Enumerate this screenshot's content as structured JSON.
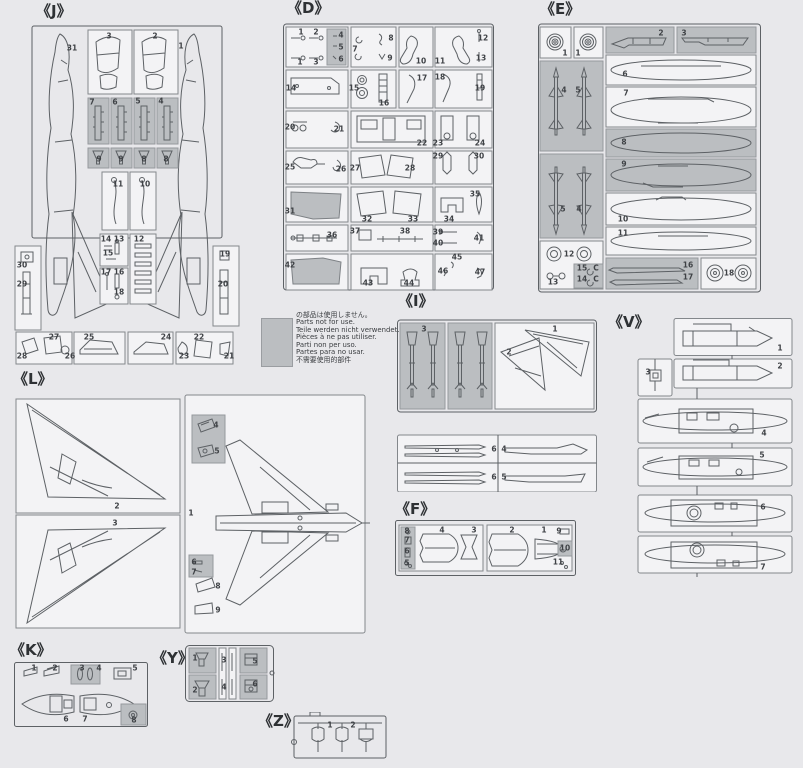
{
  "colors": {
    "background": "#e8e8eb",
    "box_fill": "#f3f3f5",
    "shaded_fill": "#bbbec1",
    "line": "#5d6165",
    "frame": "#83878b",
    "text": "#3f4246"
  },
  "note": {
    "lines": [
      "の部品は使用しません。",
      "Parts not for use.",
      "Teile werden nicht verwendet.",
      "Pièces à ne pas utiliser.",
      "Parti non per uso.",
      "Partes para no usar.",
      "不需要使用的部件"
    ]
  },
  "sprues": {
    "J": {
      "label": "《J》",
      "parts": [
        {
          "t": "31",
          "x": 58,
          "y": 26
        },
        {
          "t": "3",
          "x": 95,
          "y": 14
        },
        {
          "t": "2",
          "x": 141,
          "y": 14
        },
        {
          "t": "1",
          "x": 167,
          "y": 24
        },
        {
          "t": "7",
          "x": 78,
          "y": 80
        },
        {
          "t": "6",
          "x": 101,
          "y": 80
        },
        {
          "t": "5",
          "x": 124,
          "y": 79
        },
        {
          "t": "4",
          "x": 147,
          "y": 79
        },
        {
          "t": "9",
          "x": 85,
          "y": 137
        },
        {
          "t": "9",
          "x": 107,
          "y": 137
        },
        {
          "t": "8",
          "x": 130,
          "y": 137
        },
        {
          "t": "8",
          "x": 152,
          "y": 137
        },
        {
          "t": "11",
          "x": 104,
          "y": 162
        },
        {
          "t": "10",
          "x": 131,
          "y": 162
        },
        {
          "t": "14",
          "x": 92,
          "y": 217
        },
        {
          "t": "13",
          "x": 105,
          "y": 217
        },
        {
          "t": "15",
          "x": 94,
          "y": 231
        },
        {
          "t": "12",
          "x": 125,
          "y": 217
        },
        {
          "t": "17",
          "x": 92,
          "y": 250
        },
        {
          "t": "16",
          "x": 105,
          "y": 250
        },
        {
          "t": "18",
          "x": 105,
          "y": 270
        },
        {
          "t": "30",
          "x": 8,
          "y": 243
        },
        {
          "t": "29",
          "x": 8,
          "y": 262
        },
        {
          "t": "19",
          "x": 211,
          "y": 232
        },
        {
          "t": "20",
          "x": 209,
          "y": 262
        },
        {
          "t": "28",
          "x": 8,
          "y": 334
        },
        {
          "t": "27",
          "x": 40,
          "y": 315
        },
        {
          "t": "26",
          "x": 56,
          "y": 334
        },
        {
          "t": "25",
          "x": 75,
          "y": 315
        },
        {
          "t": "24",
          "x": 152,
          "y": 315
        },
        {
          "t": "23",
          "x": 170,
          "y": 334
        },
        {
          "t": "22",
          "x": 185,
          "y": 315
        },
        {
          "t": "21",
          "x": 215,
          "y": 334
        }
      ]
    },
    "D": {
      "label": "《D》",
      "parts": [
        {
          "t": "1",
          "x": 18,
          "y": 10
        },
        {
          "t": "2",
          "x": 33,
          "y": 10
        },
        {
          "t": "1",
          "x": 17,
          "y": 40
        },
        {
          "t": "3",
          "x": 33,
          "y": 40
        },
        {
          "t": "4",
          "x": 58,
          "y": 13
        },
        {
          "t": "5",
          "x": 58,
          "y": 25
        },
        {
          "t": "6",
          "x": 58,
          "y": 37
        },
        {
          "t": "7",
          "x": 72,
          "y": 27
        },
        {
          "t": "8",
          "x": 108,
          "y": 16
        },
        {
          "t": "9",
          "x": 107,
          "y": 36
        },
        {
          "t": "10",
          "x": 138,
          "y": 39
        },
        {
          "t": "11",
          "x": 157,
          "y": 39
        },
        {
          "t": "12",
          "x": 200,
          "y": 16
        },
        {
          "t": "13",
          "x": 198,
          "y": 36
        },
        {
          "t": "14",
          "x": 8,
          "y": 66
        },
        {
          "t": "15",
          "x": 71,
          "y": 66
        },
        {
          "t": "16",
          "x": 101,
          "y": 81
        },
        {
          "t": "17",
          "x": 139,
          "y": 56
        },
        {
          "t": "18",
          "x": 157,
          "y": 55
        },
        {
          "t": "19",
          "x": 197,
          "y": 66
        },
        {
          "t": "20",
          "x": 7,
          "y": 105
        },
        {
          "t": "21",
          "x": 56,
          "y": 107
        },
        {
          "t": "22",
          "x": 139,
          "y": 121
        },
        {
          "t": "23",
          "x": 155,
          "y": 121
        },
        {
          "t": "24",
          "x": 197,
          "y": 121
        },
        {
          "t": "25",
          "x": 7,
          "y": 145
        },
        {
          "t": "26",
          "x": 58,
          "y": 147
        },
        {
          "t": "27",
          "x": 72,
          "y": 146
        },
        {
          "t": "28",
          "x": 127,
          "y": 146
        },
        {
          "t": "29",
          "x": 155,
          "y": 134
        },
        {
          "t": "30",
          "x": 196,
          "y": 134
        },
        {
          "t": "31",
          "x": 7,
          "y": 189
        },
        {
          "t": "32",
          "x": 84,
          "y": 197
        },
        {
          "t": "33",
          "x": 130,
          "y": 197
        },
        {
          "t": "34",
          "x": 166,
          "y": 197
        },
        {
          "t": "35",
          "x": 192,
          "y": 172
        },
        {
          "t": "36",
          "x": 49,
          "y": 213
        },
        {
          "t": "37",
          "x": 72,
          "y": 209
        },
        {
          "t": "38",
          "x": 122,
          "y": 209
        },
        {
          "t": "39",
          "x": 155,
          "y": 210
        },
        {
          "t": "40",
          "x": 155,
          "y": 221
        },
        {
          "t": "41",
          "x": 196,
          "y": 216
        },
        {
          "t": "42",
          "x": 7,
          "y": 243
        },
        {
          "t": "43",
          "x": 85,
          "y": 261
        },
        {
          "t": "44",
          "x": 126,
          "y": 261
        },
        {
          "t": "45",
          "x": 174,
          "y": 235
        },
        {
          "t": "46",
          "x": 160,
          "y": 249
        },
        {
          "t": "47",
          "x": 197,
          "y": 250
        }
      ]
    },
    "E": {
      "label": "《E》",
      "parts": [
        {
          "t": "1",
          "x": 27,
          "y": 31
        },
        {
          "t": "1",
          "x": 40,
          "y": 31
        },
        {
          "t": "2",
          "x": 123,
          "y": 11
        },
        {
          "t": "3",
          "x": 146,
          "y": 11
        },
        {
          "t": "4",
          "x": 26,
          "y": 68
        },
        {
          "t": "5",
          "x": 40,
          "y": 68
        },
        {
          "t": "6",
          "x": 87,
          "y": 52
        },
        {
          "t": "7",
          "x": 88,
          "y": 71
        },
        {
          "t": "8",
          "x": 86,
          "y": 120
        },
        {
          "t": "5",
          "x": 25,
          "y": 187
        },
        {
          "t": "4",
          "x": 41,
          "y": 187
        },
        {
          "t": "9",
          "x": 86,
          "y": 142
        },
        {
          "t": "10",
          "x": 85,
          "y": 197
        },
        {
          "t": "11",
          "x": 85,
          "y": 211
        },
        {
          "t": "12",
          "x": 31,
          "y": 232
        },
        {
          "t": "13",
          "x": 15,
          "y": 260
        },
        {
          "t": "15",
          "x": 44,
          "y": 246
        },
        {
          "t": "C",
          "x": 58,
          "y": 246
        },
        {
          "t": "14",
          "x": 44,
          "y": 257
        },
        {
          "t": "C",
          "x": 58,
          "y": 257
        },
        {
          "t": "16",
          "x": 150,
          "y": 243
        },
        {
          "t": "17",
          "x": 150,
          "y": 255
        },
        {
          "t": "18",
          "x": 191,
          "y": 251
        }
      ]
    },
    "I": {
      "label": "《I》",
      "parts": [
        {
          "t": "3",
          "x": 27,
          "y": 13
        },
        {
          "t": "1",
          "x": 158,
          "y": 13
        },
        {
          "t": "2",
          "x": 112,
          "y": 36
        },
        {
          "t": "6",
          "x": 97,
          "y": 133
        },
        {
          "t": "4",
          "x": 107,
          "y": 133
        },
        {
          "t": "6",
          "x": 97,
          "y": 161
        },
        {
          "t": "5",
          "x": 107,
          "y": 161
        }
      ]
    },
    "V": {
      "label": "《V》",
      "parts": [
        {
          "t": "1",
          "x": 143,
          "y": 30
        },
        {
          "t": "2",
          "x": 143,
          "y": 48
        },
        {
          "t": "3",
          "x": 11,
          "y": 54
        },
        {
          "t": "4",
          "x": 127,
          "y": 115
        },
        {
          "t": "5",
          "x": 125,
          "y": 137
        },
        {
          "t": "6",
          "x": 126,
          "y": 189
        },
        {
          "t": "7",
          "x": 126,
          "y": 249
        }
      ]
    },
    "L": {
      "label": "《L》",
      "parts": [
        {
          "t": "2",
          "x": 107,
          "y": 114
        },
        {
          "t": "3",
          "x": 105,
          "y": 131
        },
        {
          "t": "4",
          "x": 206,
          "y": 33
        },
        {
          "t": "5",
          "x": 207,
          "y": 59
        },
        {
          "t": "1",
          "x": 181,
          "y": 121
        },
        {
          "t": "6",
          "x": 184,
          "y": 170
        },
        {
          "t": "7",
          "x": 184,
          "y": 180
        },
        {
          "t": "8",
          "x": 208,
          "y": 194
        },
        {
          "t": "9",
          "x": 208,
          "y": 218
        }
      ]
    },
    "F": {
      "label": "《F》",
      "parts": [
        {
          "t": "8",
          "x": 12,
          "y": 11
        },
        {
          "t": "7",
          "x": 12,
          "y": 20
        },
        {
          "t": "6",
          "x": 12,
          "y": 31
        },
        {
          "t": "5",
          "x": 12,
          "y": 43
        },
        {
          "t": "4",
          "x": 47,
          "y": 10
        },
        {
          "t": "3",
          "x": 79,
          "y": 10
        },
        {
          "t": "2",
          "x": 117,
          "y": 10
        },
        {
          "t": "1",
          "x": 149,
          "y": 10
        },
        {
          "t": "9",
          "x": 164,
          "y": 11
        },
        {
          "t": "10",
          "x": 170,
          "y": 28
        },
        {
          "t": "11",
          "x": 163,
          "y": 42
        }
      ]
    },
    "K": {
      "label": "《K》",
      "parts": [
        {
          "t": "1",
          "x": 20,
          "y": 6
        },
        {
          "t": "2",
          "x": 41,
          "y": 6
        },
        {
          "t": "3",
          "x": 68,
          "y": 6
        },
        {
          "t": "4",
          "x": 85,
          "y": 6
        },
        {
          "t": "5",
          "x": 121,
          "y": 6
        },
        {
          "t": "6",
          "x": 52,
          "y": 57
        },
        {
          "t": "7",
          "x": 71,
          "y": 57
        },
        {
          "t": "8",
          "x": 120,
          "y": 58
        }
      ]
    },
    "Y": {
      "label": "《Y》",
      "parts": [
        {
          "t": "1",
          "x": 10,
          "y": 13
        },
        {
          "t": "2",
          "x": 10,
          "y": 45
        },
        {
          "t": "3",
          "x": 39,
          "y": 15
        },
        {
          "t": "4",
          "x": 39,
          "y": 42
        },
        {
          "t": "5",
          "x": 70,
          "y": 16
        },
        {
          "t": "6",
          "x": 70,
          "y": 39
        }
      ]
    },
    "Z": {
      "label": "《Z》",
      "parts": [
        {
          "t": "1",
          "x": 40,
          "y": 13
        },
        {
          "t": "2",
          "x": 63,
          "y": 13
        }
      ]
    }
  }
}
